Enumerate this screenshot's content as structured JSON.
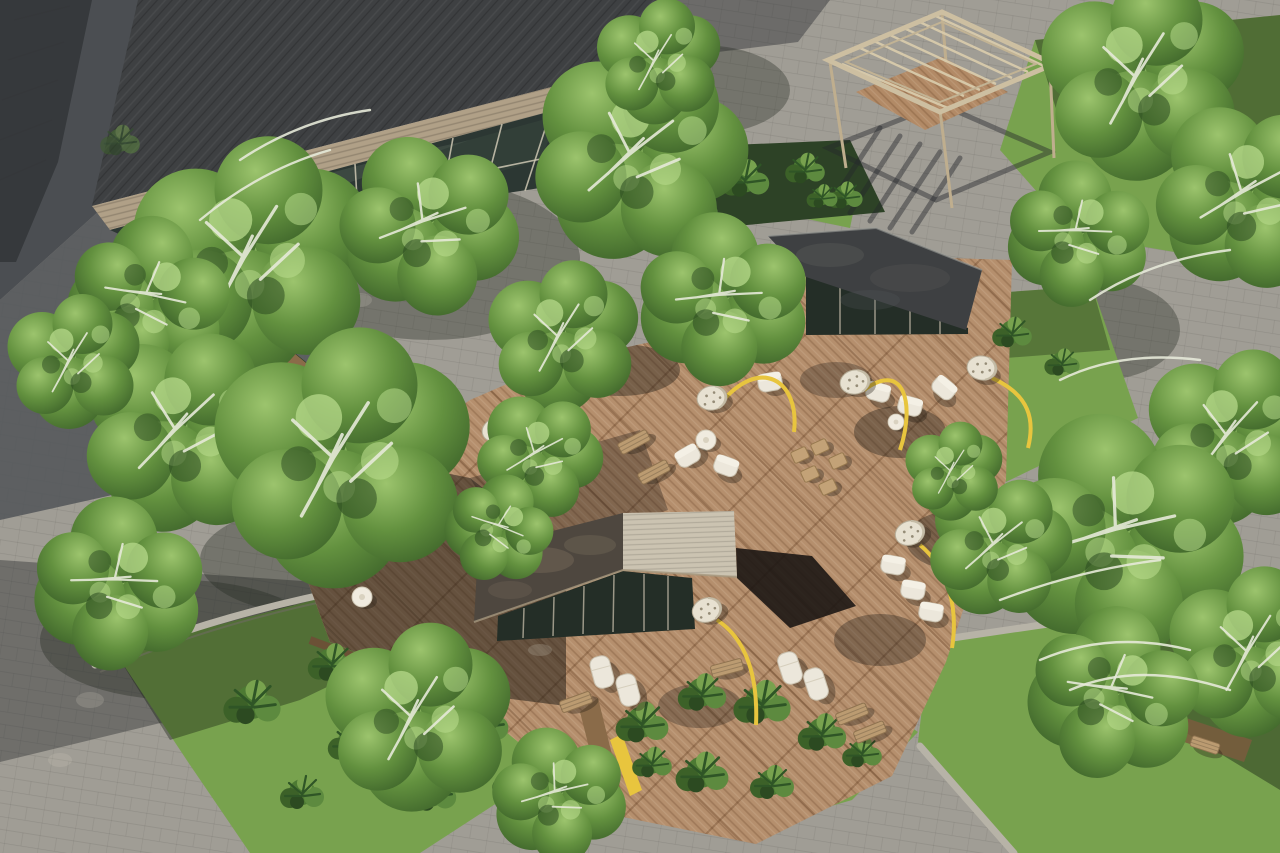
{
  "scene": {
    "kind": "aerial-courtyard-render",
    "elements": [
      "glass-lobby-building",
      "tower-edge",
      "louvered-pergola",
      "glass-pavilion-dark-roof",
      "glass-pavilion-ribbed-roof",
      "timber-deck",
      "stone-paving",
      "lawns",
      "planter-beds",
      "birch-trees",
      "tropical-shrubs",
      "white-lounge-chairs",
      "wood-benches",
      "round-tables",
      "wicker-arc-lamps",
      "yellow-bench-strips",
      "stone-curbs",
      "cast-shadows"
    ]
  },
  "palette": {
    "paving": "#a09d95",
    "pavingShadow": "#4b4e52",
    "pavingShadow2": "#53565a",
    "deck": "#b58f6d",
    "deckShade": "#3a322a",
    "grass": "#78a24e",
    "grassShade": "#44633a",
    "bedDark": "#2d4226",
    "foliageLight": "#9cc46d",
    "foliageMid": "#63913f",
    "foliageDark": "#41682c",
    "branchWhite": "#e6e9d8",
    "roofDark": "#3e4042",
    "roofTan": "#b0a087",
    "roofRibbed": "#cbc3b1",
    "glass": "#2c3733",
    "glassPavilion": "#242e27",
    "mullion": "#cfc8b4",
    "pergolaFrame": "#cdbfa1",
    "woodWall": "#8a6b49",
    "benchWood": "#bb9b71",
    "accentYellow": "#e8c53e",
    "furnitureWhite": "#ece7db",
    "lampShade": "#e7e1d1",
    "curb": "#b7b3a7",
    "towerFacade": "#36393c"
  }
}
